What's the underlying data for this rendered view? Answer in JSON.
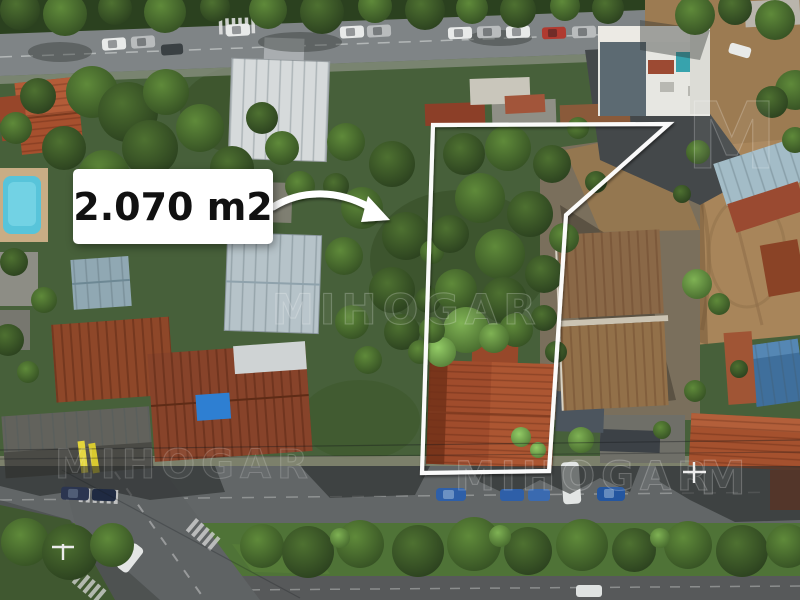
{
  "annotation": {
    "area_label": "2.070 m2",
    "polygon_points": "433,125 669,124 566,215 549,471 422,473",
    "outline_color": "#ffffff",
    "label_background": "#ffffff",
    "label_text_color": "#111111"
  },
  "watermark": {
    "text": "MIHOGAR",
    "monogram": "M"
  }
}
